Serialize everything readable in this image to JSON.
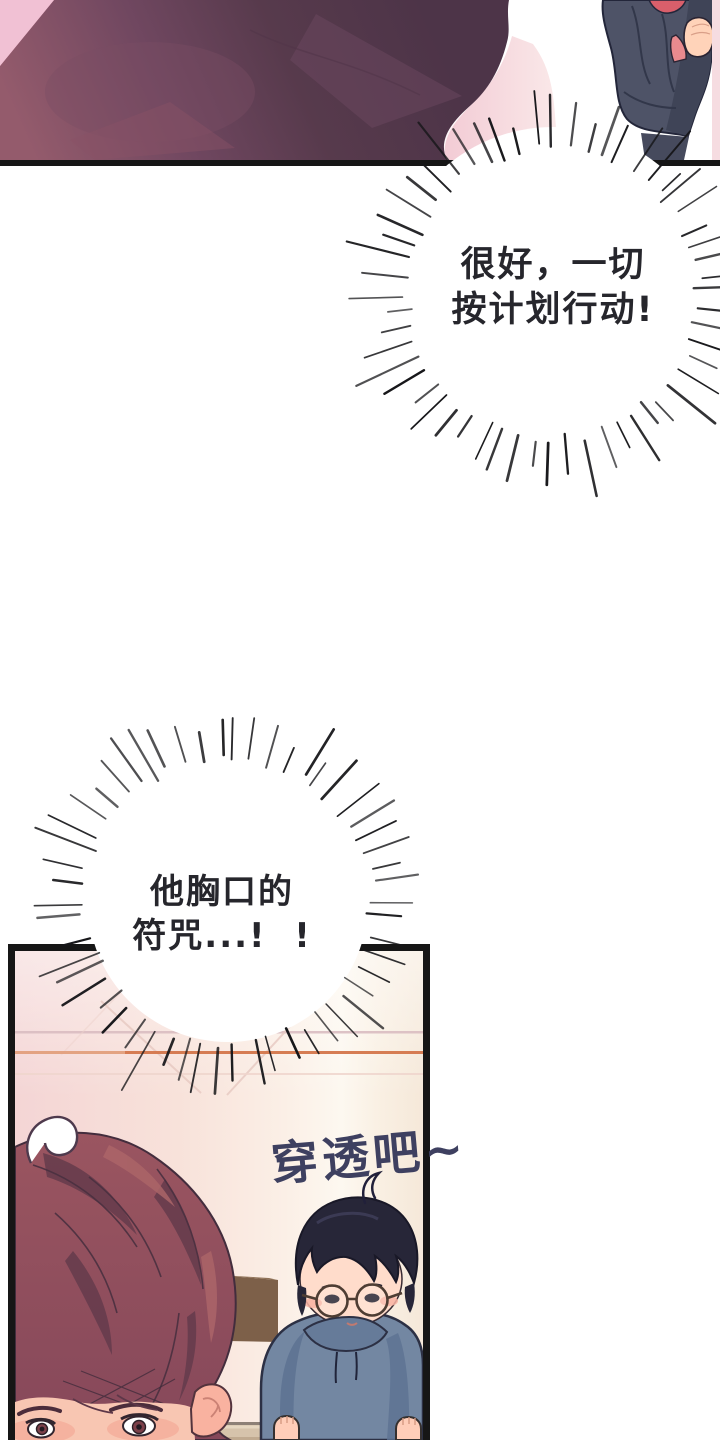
{
  "page": {
    "kind": "webtoon comic page",
    "background": "#ffffff"
  },
  "palette": {
    "panel_border": "#161616",
    "burst_text_color": "#26262c",
    "sfx_text_color": "#3e4060",
    "wall_pink": "#f4d5d5",
    "orange_wall_line": "#d4764b",
    "foreground_hair": "#8f4e58",
    "hoodie_blue_grey": "#7387a2",
    "jacket_navy": "#4e5367",
    "skin_tone": "#ffdccb"
  },
  "speech_bursts": [
    {
      "id": "burst-1",
      "lines": [
        "很好，一切",
        "按计划行动!"
      ]
    },
    {
      "id": "burst-2",
      "lines": [
        "他胸口的",
        "符咒...!  !"
      ]
    }
  ],
  "sfx": {
    "text": "穿透吧~"
  }
}
